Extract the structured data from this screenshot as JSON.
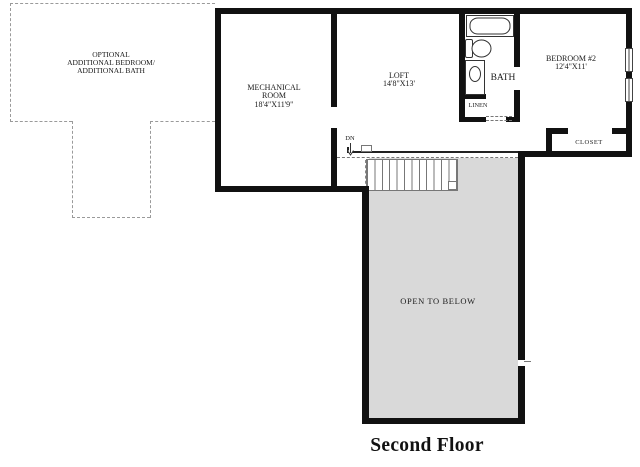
{
  "title": "Second Floor",
  "optional_area": {
    "line1": "OPTIONAL",
    "line2": "ADDITIONAL BEDROOM/",
    "line3": "ADDITIONAL BATH"
  },
  "rooms": {
    "mechanical": {
      "line1": "MECHANICAL",
      "line2": "ROOM",
      "dims": "18'4\"X11'9\""
    },
    "loft": {
      "name": "LOFT",
      "dims": "14'8\"X13'"
    },
    "bath": {
      "name": "BATH"
    },
    "linen": {
      "name": "LINEN"
    },
    "bedroom2": {
      "name": "BEDROOM #2",
      "dims": "12'4\"X11'"
    },
    "closet": {
      "name": "CLOSET"
    },
    "open_to_below": {
      "name": "OPEN TO BELOW"
    },
    "stairs": {
      "label": "DN"
    }
  },
  "colors": {
    "wall": "#111111",
    "open_below_fill": "#d9d9d9",
    "dashed_line": "#9a9a9a",
    "fixture_line": "#333333"
  }
}
